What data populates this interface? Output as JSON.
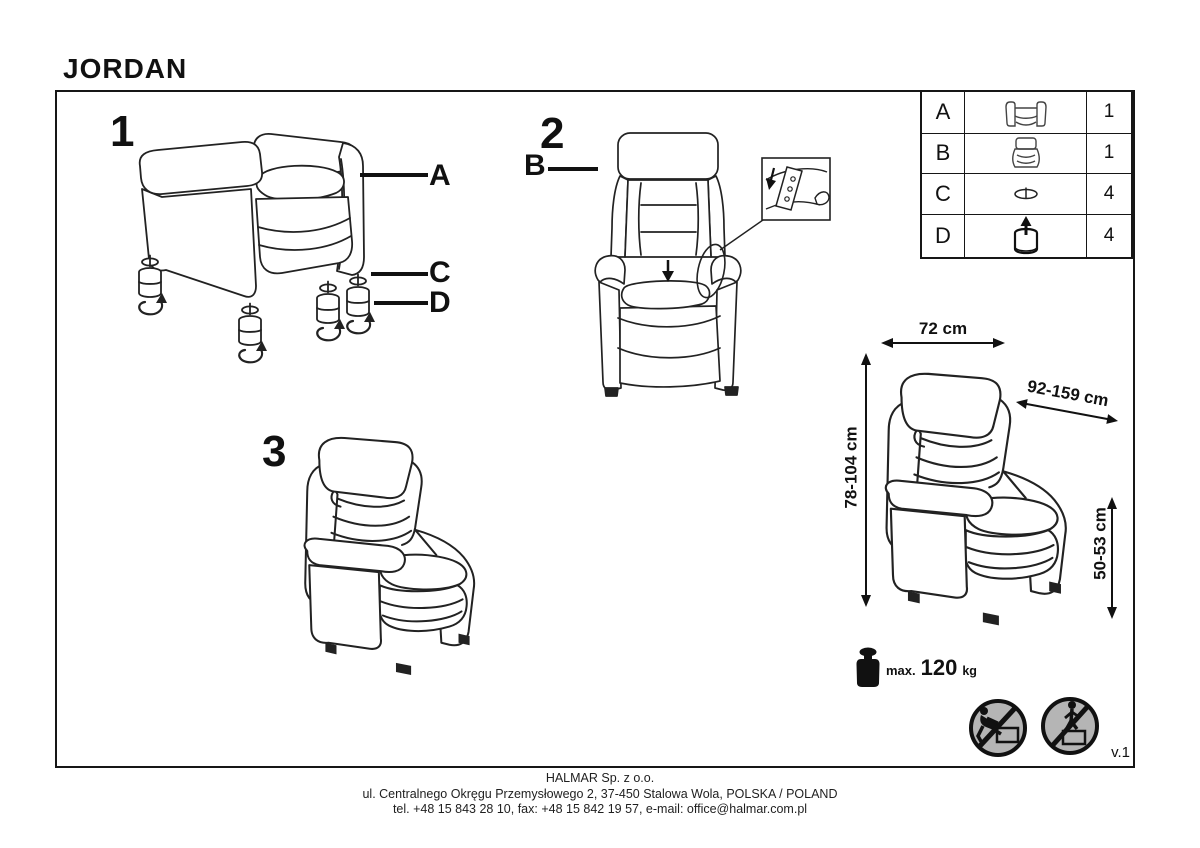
{
  "page": {
    "title": "JORDAN",
    "version": "v.1"
  },
  "figures": {
    "fig1": {
      "number": "1"
    },
    "fig2": {
      "number": "2"
    },
    "fig3": {
      "number": "3"
    }
  },
  "callouts": {
    "a": "A",
    "b": "B",
    "c": "C",
    "d": "D"
  },
  "parts_table": {
    "rows": [
      {
        "part": "A",
        "icon": "chair-base-icon",
        "qty": "1"
      },
      {
        "part": "B",
        "icon": "backrest-icon",
        "qty": "1"
      },
      {
        "part": "C",
        "icon": "washer-icon",
        "qty": "4"
      },
      {
        "part": "D",
        "icon": "leg-icon",
        "qty": "4"
      }
    ]
  },
  "dimensions": {
    "width": "72 cm",
    "depth": "92-159 cm",
    "height": "78-104 cm",
    "seat_height": "50-53 cm"
  },
  "max_load": {
    "prefix": "max.",
    "value": "120",
    "unit": "kg"
  },
  "safety_icons": [
    "no-climbing-sign",
    "no-standing-on-furniture-sign"
  ],
  "footer": {
    "company": "HALMAR Sp. z o.o.",
    "address": "ul. Centralnego Okręgu Przemysłowego 2, 37-450 Stalowa Wola, POLSKA / POLAND",
    "contact": "tel. +48 15 843 28 10, fax: +48 15 842 19 57, e-mail: office@halmar.com.pl"
  },
  "colors": {
    "ink": "#161616",
    "sign_fill": "#b5b5b5"
  }
}
